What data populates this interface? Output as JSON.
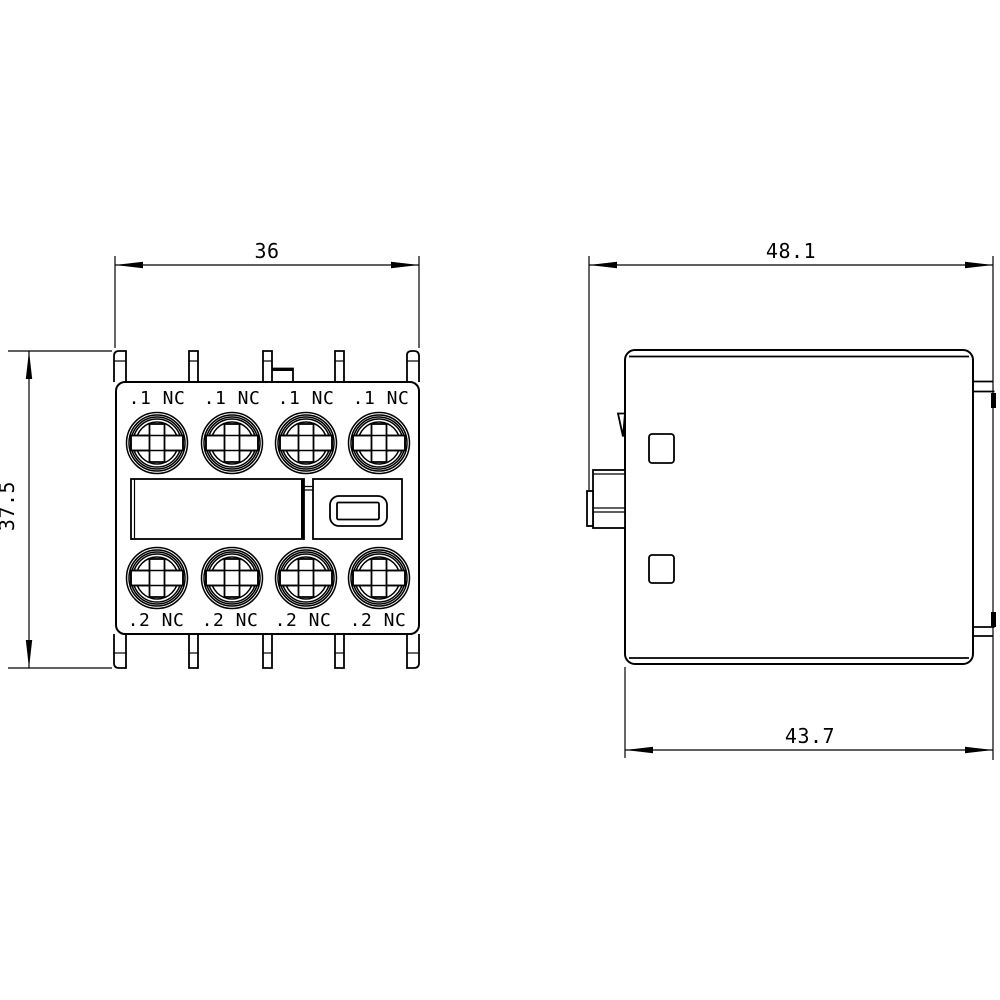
{
  "colors": {
    "line": "#000000",
    "background": "#ffffff"
  },
  "front_view": {
    "dimensions": {
      "width": "36",
      "height": "37.5"
    },
    "terminal_labels_top": [
      ".1 NC",
      ".1 NC",
      ".1 NC",
      ".1 NC"
    ],
    "terminal_labels_bottom": [
      ".2 NC",
      ".2 NC",
      ".2 NC",
      ".2 NC"
    ]
  },
  "side_view": {
    "dimensions": {
      "width_overall": "48.1",
      "width_body": "43.7"
    }
  }
}
